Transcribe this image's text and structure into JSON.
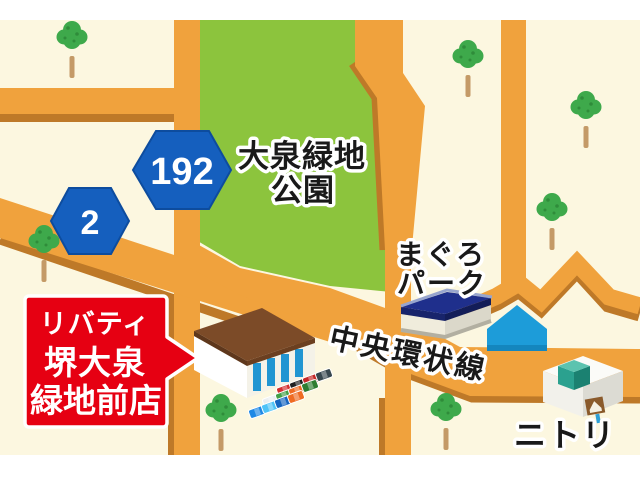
{
  "map": {
    "park": {
      "label_line1": "大泉緑地",
      "label_line2": "公園"
    },
    "route_badges": [
      {
        "number": "192"
      },
      {
        "number": "2"
      }
    ],
    "road_label": "中央環状線",
    "store_sign": {
      "line1": "リバティ",
      "line2": "堺大泉",
      "line3": "緑地前店"
    },
    "pois": {
      "maguro_line1": "まぐろ",
      "maguro_line2": "パーク",
      "nitori": "ニトリ"
    },
    "parking": {
      "car_colors": [
        "#d32f2f",
        "#212121",
        "#c62828",
        "#37474f",
        "#eceff1",
        "#43a047",
        "#ef6c23",
        "#2e7d32",
        "#1e88e5",
        "#4fc3f7",
        "#1565c0",
        "#ef6c23"
      ]
    },
    "colors": {
      "background": "#FCF7E0",
      "road": "#F0A23D",
      "road_shadow": "#BE7928",
      "park_green": "#8CC43D",
      "badge_blue": "#155FBE",
      "sign_red": "#E60012",
      "house_blue": "#1D9CD9",
      "nitori_teal": "#2BA18F"
    }
  }
}
